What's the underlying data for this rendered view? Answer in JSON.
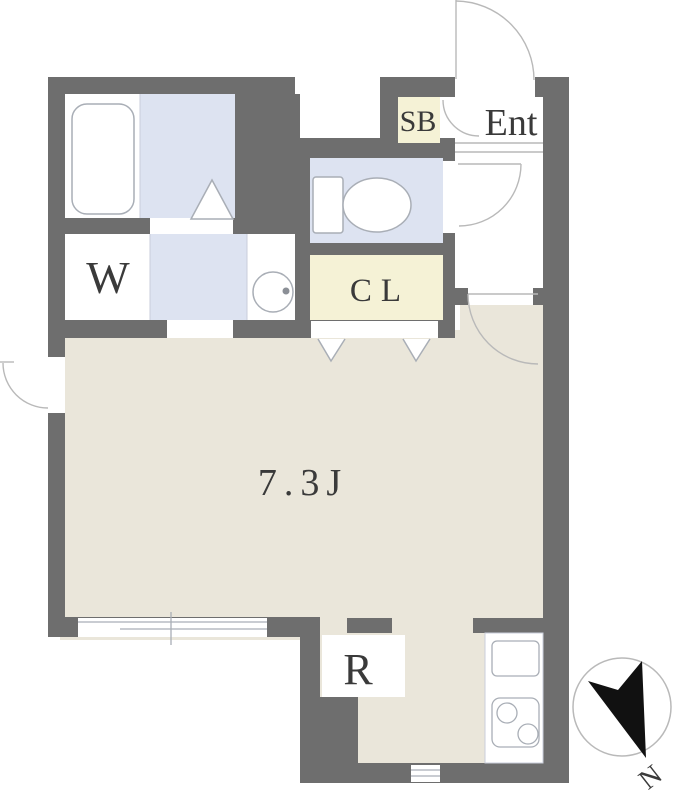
{
  "plan": {
    "type": "apartment-floor-plan",
    "rooms": {
      "main_room": {
        "label": "7.3J",
        "kind": "living-room"
      },
      "entrance": {
        "label": "Ent",
        "kind": "entrance"
      },
      "shoe_box": {
        "label": "SB",
        "kind": "shoe-cabinet"
      },
      "closet": {
        "label": "CL",
        "kind": "closet"
      },
      "washer": {
        "label": "W",
        "kind": "washing-machine-space"
      },
      "refrigerator": {
        "label": "R",
        "kind": "refrigerator-space"
      }
    },
    "compass": {
      "label": "N"
    }
  },
  "colors": {
    "wall": "#6e6e6e",
    "floor_main": "#eae6da",
    "floor_wet": "#dde3f1",
    "floor_closet": "#f5f2d6",
    "white": "#ffffff",
    "fixture_stroke": "#a9aeb6",
    "door_stroke": "#b9b9b9",
    "text": "#3a3a3a",
    "compass_needle": "#111111"
  }
}
